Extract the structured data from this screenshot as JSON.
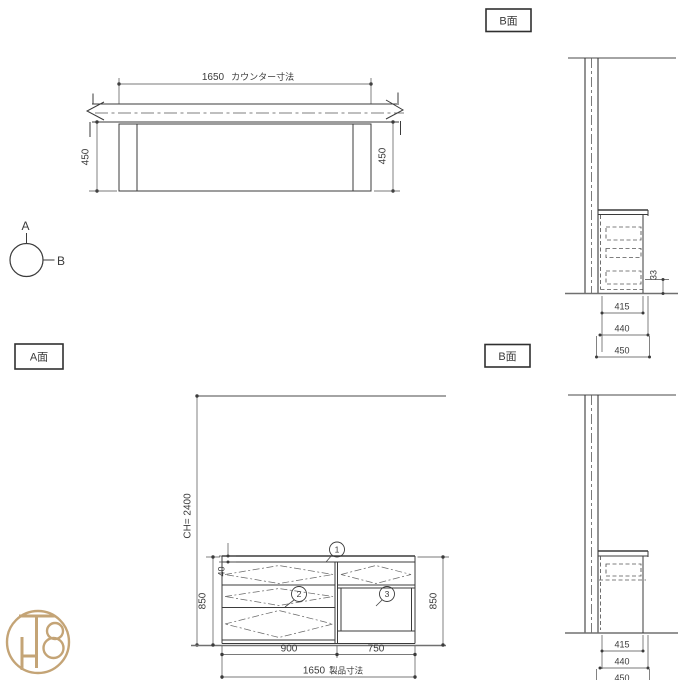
{
  "meta": {
    "type": "cad-furniture-drawing",
    "background": "#ffffff",
    "line_color": "#3b3b3b",
    "dim_color": "#4d4d4d",
    "logo_color": "#c4a476"
  },
  "plan": {
    "counter_dim": "1650",
    "counter_dim_label": "カウンター寸法",
    "depth_left": "450",
    "depth_right": "450"
  },
  "indicator": {
    "a": "A",
    "b": "B"
  },
  "labels": {
    "a_view": "A面",
    "b_view_top": "B面",
    "b_view_bottom": "B面"
  },
  "elevation_a": {
    "ceiling_height": "CH= 2400",
    "counter_thickness": "40",
    "height_left": "850",
    "height_right": "850",
    "width_left": "900",
    "width_right": "750",
    "total_width": "1650",
    "total_width_label": "製品寸法",
    "callout_1": "1",
    "callout_2": "2",
    "callout_3": "3"
  },
  "section_b_top": {
    "kick_height": "33",
    "depth_inner": "415",
    "depth_mid": "440",
    "depth_outer": "450"
  },
  "section_b_bottom": {
    "depth_inner": "415",
    "depth_mid": "440",
    "depth_outer": "450"
  },
  "logo": {
    "monogram": "TH8"
  }
}
